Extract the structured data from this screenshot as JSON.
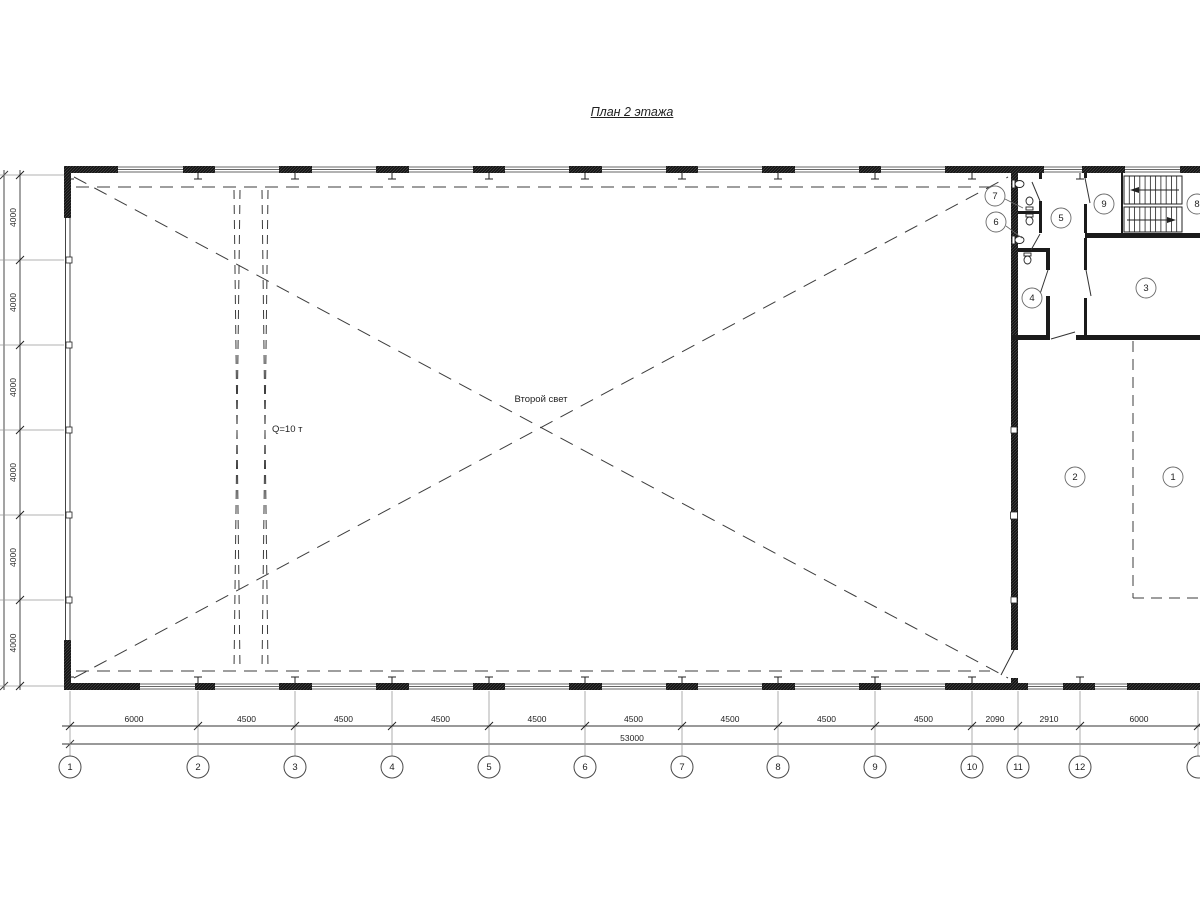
{
  "drawing": {
    "title": "План 2 этажа",
    "labels": {
      "second_light": "Второй свет",
      "crane_capacity": "Q=10 т"
    }
  },
  "grid": {
    "bottom_axes": [
      {
        "label": "1",
        "x": 70
      },
      {
        "label": "2",
        "x": 198
      },
      {
        "label": "3",
        "x": 295
      },
      {
        "label": "4",
        "x": 392
      },
      {
        "label": "5",
        "x": 489
      },
      {
        "label": "6",
        "x": 585
      },
      {
        "label": "7",
        "x": 682
      },
      {
        "label": "8",
        "x": 778
      },
      {
        "label": "9",
        "x": 875
      },
      {
        "label": "10",
        "x": 972
      },
      {
        "label": "11",
        "x": 1018
      },
      {
        "label": "12",
        "x": 1080
      },
      {
        "label": "",
        "x": 1198
      }
    ],
    "bottom_dims": [
      {
        "text": "6000",
        "x1": 70,
        "x2": 198
      },
      {
        "text": "4500",
        "x1": 198,
        "x2": 295
      },
      {
        "text": "4500",
        "x1": 295,
        "x2": 392
      },
      {
        "text": "4500",
        "x1": 392,
        "x2": 489
      },
      {
        "text": "4500",
        "x1": 489,
        "x2": 585
      },
      {
        "text": "4500",
        "x1": 585,
        "x2": 682
      },
      {
        "text": "4500",
        "x1": 682,
        "x2": 778
      },
      {
        "text": "4500",
        "x1": 778,
        "x2": 875
      },
      {
        "text": "4500",
        "x1": 875,
        "x2": 972
      },
      {
        "text": "2090",
        "x1": 972,
        "x2": 1018
      },
      {
        "text": "2910",
        "x1": 1018,
        "x2": 1080
      },
      {
        "text": "6000",
        "x1": 1080,
        "x2": 1198
      }
    ],
    "bottom_total": "53000",
    "left_dims": [
      {
        "text": "4000",
        "y1": 175,
        "y2": 260
      },
      {
        "text": "4000",
        "y1": 260,
        "y2": 345
      },
      {
        "text": "4000",
        "y1": 345,
        "y2": 430
      },
      {
        "text": "4000",
        "y1": 430,
        "y2": 515
      },
      {
        "text": "4000",
        "y1": 515,
        "y2": 600
      },
      {
        "text": "4000",
        "y1": 600,
        "y2": 686
      }
    ]
  },
  "rooms": [
    {
      "number": "1",
      "x": 1173,
      "y": 477
    },
    {
      "number": "2",
      "x": 1075,
      "y": 477
    },
    {
      "number": "3",
      "x": 1146,
      "y": 288
    },
    {
      "number": "4",
      "x": 1032,
      "y": 298
    },
    {
      "number": "5",
      "x": 1061,
      "y": 218
    },
    {
      "number": "6",
      "x": 996,
      "y": 222,
      "leader": {
        "x1": 1006,
        "y1": 226,
        "x2": 1022,
        "y2": 238
      }
    },
    {
      "number": "7",
      "x": 995,
      "y": 196,
      "leader": {
        "x1": 1005,
        "y1": 199,
        "x2": 1023,
        "y2": 208
      }
    },
    {
      "number": "8",
      "x": 1197,
      "y": 204
    },
    {
      "number": "9",
      "x": 1104,
      "y": 204
    }
  ]
}
